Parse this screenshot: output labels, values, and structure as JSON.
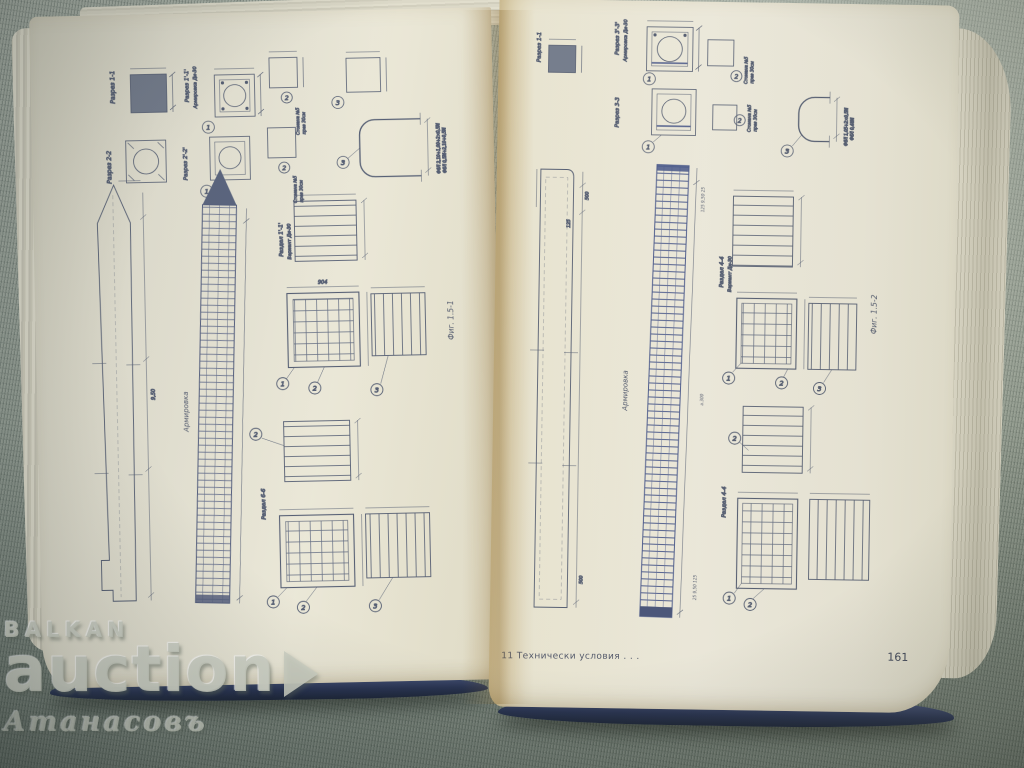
{
  "photo": {
    "subject": "Open technical book with reinforced-concrete pile working drawings, photographed on green woven fabric",
    "background_color": "#97a096",
    "page_color": "#ebe8d8",
    "ink_color": "#4a546c",
    "rebar_blue": "#47568a",
    "cover_edge_color": "#273250"
  },
  "watermark": {
    "brand_top": "BALKAN",
    "brand_main": "auction",
    "name": "Атанасовъ"
  },
  "left_page": {
    "fig_label": "Фиг. 1.5-1",
    "sections": {
      "s11": "Разрез 1-1",
      "s22": "Разрез 2-2",
      "s11p": "Разрез 1'-1'",
      "s22p": "Разрез 2'-2'",
      "armd": "Армировка Ди-30",
      "steel_note_1": "Стомана №5",
      "steel_note_2": "през 30см"
    },
    "reinforcement_label": "Армировка",
    "details": {
      "upper_title": "Раздел 1'-1'",
      "upper_variant": "Вариант Ди-30",
      "lower_title": "Раздел 6-6"
    },
    "dims": {
      "mesh_width": "904",
      "pile_length": "9,50"
    },
    "notes": {
      "ubar_1": "Ф6Л 2,10+1,00+2×0,5М",
      "ubar_2": "Ф6Л 0,5М+2,10+0,5М"
    },
    "callouts": {
      "c1": "1",
      "c2": "2",
      "c3": "3"
    }
  },
  "right_page": {
    "fig_label": "Фиг. 1.5-2",
    "sections": {
      "s11": "Разрез 1-1",
      "s33": "Разрез 3-3",
      "s33p": "Разрез 3'-3'",
      "armd": "Армировка Ди-30",
      "steel_note_1": "Стомана №5",
      "steel_note_2": "през 30см"
    },
    "reinforcement_label": "Армировка",
    "details": {
      "upper_title": "Раздел 4-4",
      "upper_variant": "Вариант Ди-30",
      "lower_title": "Раздел 4-4"
    },
    "dims": {
      "top_500": "500",
      "top_125": "125",
      "bot_500": "500",
      "top_seq": "125  9,50  25",
      "bot_seq": "25  9,50  125",
      "spacing": "а.300"
    },
    "notes": {
      "ubar_1": "Ф6Л 1,05+2×0,5М",
      "ubar_2": "Ф6Л 0,48М"
    },
    "callouts": {
      "c1": "1",
      "c2": "2",
      "c3": "3"
    },
    "footer": "11 Технически условия . . .",
    "page_number": "161"
  }
}
